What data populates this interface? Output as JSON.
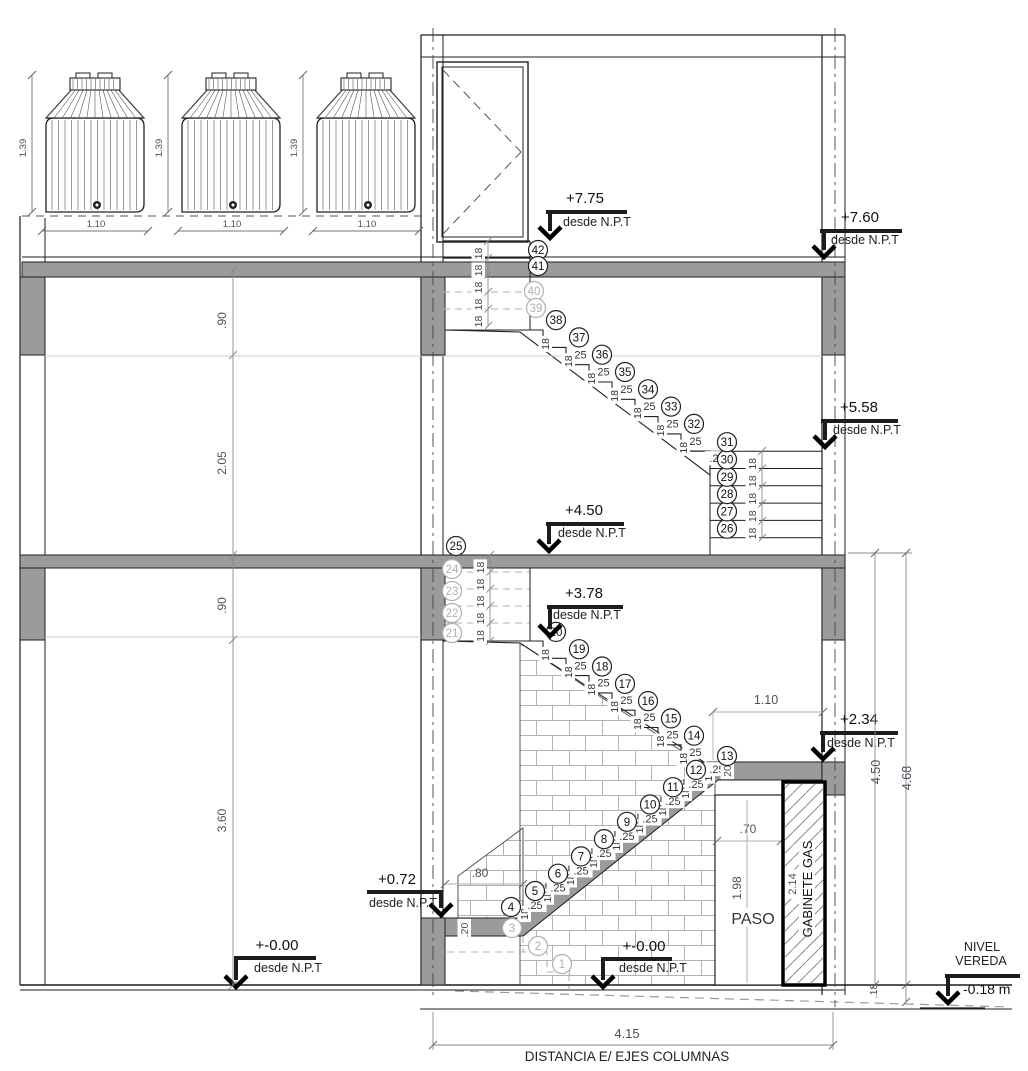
{
  "drawing": {
    "type": "stair-section",
    "bottom_caption": "DISTANCIA E/ EJES COLUMNAS",
    "bottom_dim": "4.15"
  },
  "tanks": {
    "count": 3,
    "height_label": "1.39",
    "width_label": "1.10"
  },
  "elevation_markers": [
    {
      "id": "m775",
      "value": "+7.75",
      "note": "desde N.P.T"
    },
    {
      "id": "m760",
      "value": "+7.60",
      "note": "desde N.P.T"
    },
    {
      "id": "m558",
      "value": "+5.58",
      "note": "desde N.P.T"
    },
    {
      "id": "m450",
      "value": "+4.50",
      "note": "desde N.P.T"
    },
    {
      "id": "m378",
      "value": "+3.78",
      "note": "desde N.P.T"
    },
    {
      "id": "m234",
      "value": "+2.34",
      "note": "desde N.P.T"
    },
    {
      "id": "m072",
      "value": "+0.72",
      "note": "desde N.P.T"
    },
    {
      "id": "m000L",
      "value": "+-0.00",
      "note": "desde N.P.T"
    },
    {
      "id": "m000M",
      "value": "+-0.00",
      "note": "desde N.P.T"
    }
  ],
  "sidewalk_marker": {
    "line1": "NIVEL",
    "line2": "VEREDA",
    "value": "-0.18  m"
  },
  "dimensions": {
    "left_chain": [
      ".90",
      "2.05",
      ".90",
      "3.60"
    ],
    "right_chain": {
      "inner": "4.50",
      "outer": "4.68",
      "base": ".18"
    },
    "landing_width_top": "1.10",
    "landing_width_low": ".80",
    "landing_thickness_low": ".20",
    "landing_thickness_top": "20",
    "riser": "18",
    "tread": ".25",
    "paso_width": ".70",
    "paso_height": "1.98",
    "gabinete_height": "2.14"
  },
  "labels": {
    "paso": "PASO",
    "gabinete": "GABINETE GAS"
  },
  "steps": {
    "first": 1,
    "last": 42,
    "hidden": [
      1,
      2,
      3,
      21,
      22,
      23,
      24,
      39,
      40
    ]
  },
  "colors": {
    "line": "#1c1c1c",
    "concrete": "#9b9b9b",
    "hidden": "#b0b0b0",
    "dim_line": "#aab0b4",
    "dim_text": "#49525c",
    "brick": "#b3b3b3",
    "light_line": "#cccccc"
  }
}
